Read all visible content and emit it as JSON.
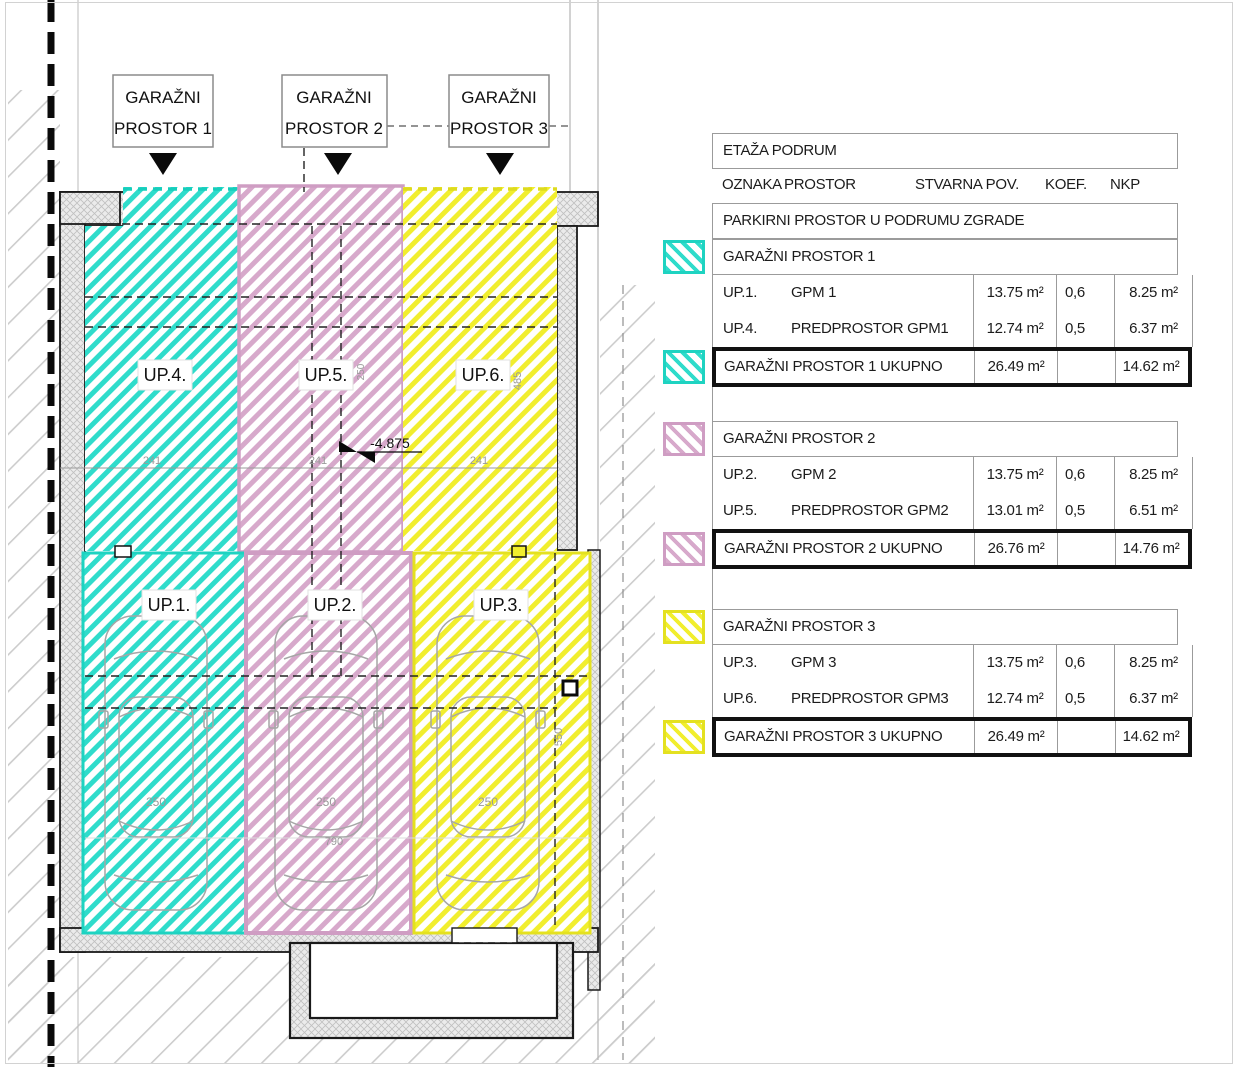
{
  "plan": {
    "garage_labels": [
      {
        "line1": "GARAŽNI",
        "line2": "PROSTOR 1"
      },
      {
        "line1": "GARAŽNI",
        "line2": "PROSTOR 2"
      },
      {
        "line1": "GARAŽNI",
        "line2": "PROSTOR 3"
      }
    ],
    "upper_rooms": [
      "UP.4.",
      "UP.5.",
      "UP.6."
    ],
    "lower_rooms": [
      "UP.1.",
      "UP.2.",
      "UP.3."
    ],
    "elevation": "-4.875",
    "dimensions": {
      "bay1": "241",
      "bay2": "241",
      "bay3": "241",
      "upper_height": "485",
      "upper_mid": "250",
      "car1": "250",
      "car2": "250",
      "car3": "250",
      "car_length": "790",
      "lower_height": "550"
    },
    "colors": {
      "cyan": "#2fdccb",
      "pink": "#d7a9cb",
      "yellow": "#f1ee2e",
      "wall": "#ebebeb"
    }
  },
  "table": {
    "title": "ETAŽA PODRUM",
    "header": {
      "c1": "OZNAKA",
      "c2": "PROSTOR",
      "c3": "STVARNA POV.",
      "c4": "KOEF.",
      "c5": "NKP"
    },
    "subtitle": "PARKIRNI PROSTOR U PODRUMU ZGRADE",
    "sections": [
      {
        "name": "GARAŽNI PROSTOR 1",
        "rows": [
          {
            "oznaka": "UP.1.",
            "prostor": "GPM 1",
            "stvarna": "13.75 m²",
            "koef": "0,6",
            "nkp": "8.25 m²"
          },
          {
            "oznaka": "UP.4.",
            "prostor": "PREDPROSTOR GPM1",
            "stvarna": "12.74 m²",
            "koef": "0,5",
            "nkp": "6.37 m²"
          }
        ],
        "total": {
          "label": "GARAŽNI PROSTOR 1 UKUPNO",
          "stvarna": "26.49 m²",
          "koef": "",
          "nkp": "14.62 m²"
        }
      },
      {
        "name": "GARAŽNI PROSTOR 2",
        "rows": [
          {
            "oznaka": "UP.2.",
            "prostor": "GPM 2",
            "stvarna": "13.75 m²",
            "koef": "0,6",
            "nkp": "8.25 m²"
          },
          {
            "oznaka": "UP.5.",
            "prostor": "PREDPROSTOR GPM2",
            "stvarna": "13.01 m²",
            "koef": "0,5",
            "nkp": "6.51 m²"
          }
        ],
        "total": {
          "label": "GARAŽNI PROSTOR 2 UKUPNO",
          "stvarna": "26.76 m²",
          "koef": "",
          "nkp": "14.76 m²"
        }
      },
      {
        "name": "GARAŽNI PROSTOR 3",
        "rows": [
          {
            "oznaka": "UP.3.",
            "prostor": "GPM 3",
            "stvarna": "13.75 m²",
            "koef": "0,6",
            "nkp": "8.25 m²"
          },
          {
            "oznaka": "UP.6.",
            "prostor": "PREDPROSTOR GPM3",
            "stvarna": "12.74 m²",
            "koef": "0,5",
            "nkp": "6.37 m²"
          }
        ],
        "total": {
          "label": "GARAŽNI PROSTOR 3 UKUPNO",
          "stvarna": "26.49 m²",
          "koef": "",
          "nkp": "14.62 m²"
        }
      }
    ]
  }
}
